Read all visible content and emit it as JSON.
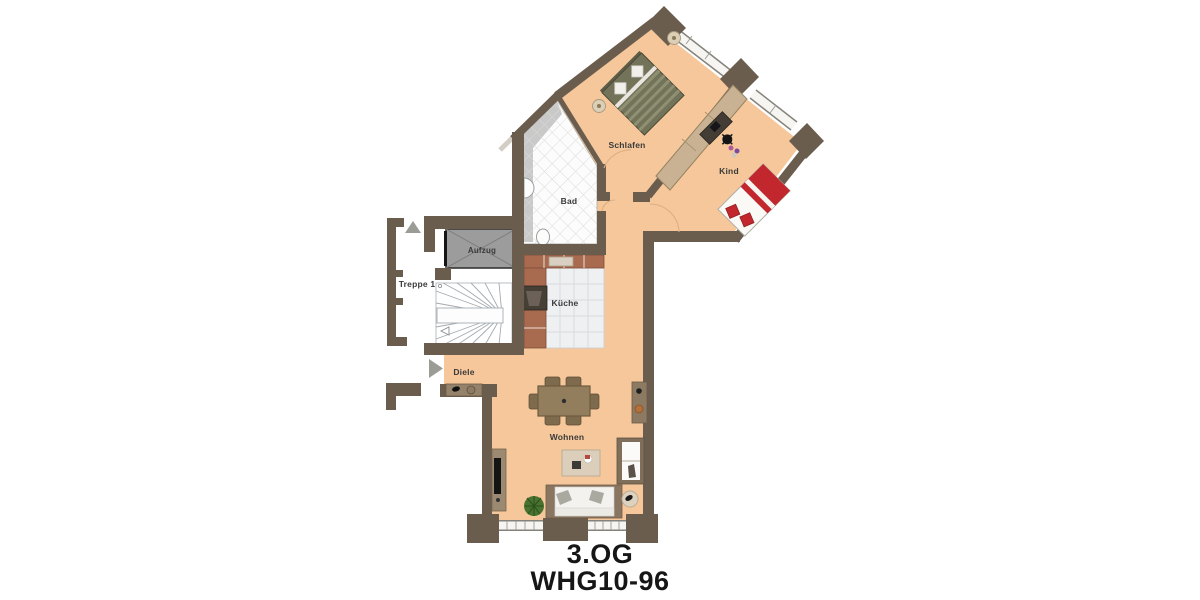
{
  "floorplan": {
    "caption": {
      "floor": "3.OG",
      "unit": "WHG10-96"
    },
    "labels": {
      "schlafen": "Schlafen",
      "kind": "Kind",
      "bad": "Bad",
      "aufzug": "Aufzug",
      "treppe": "Treppe 1",
      "kueche": "Küche",
      "diele": "Diele",
      "wohnen": "Wohnen"
    },
    "colors": {
      "wall": "#6b5d4e",
      "floor": "#f5c79a",
      "bad_tile_bg": "#fcfcfc",
      "shower": "#c9c9c9",
      "kueche_tile": "#eef0f2",
      "kitchen_counter": "#a96b50",
      "elevator": "#9c9c9c",
      "wardrobe": "#c9b294",
      "bed_accent_red": "#c1272d",
      "bed_olive": "#73735a",
      "label_text": "#3a3a3a",
      "caption_text": "#161616"
    },
    "icons": {
      "north_arrow": "up-triangle",
      "entry_arrow": "right-triangle"
    }
  }
}
